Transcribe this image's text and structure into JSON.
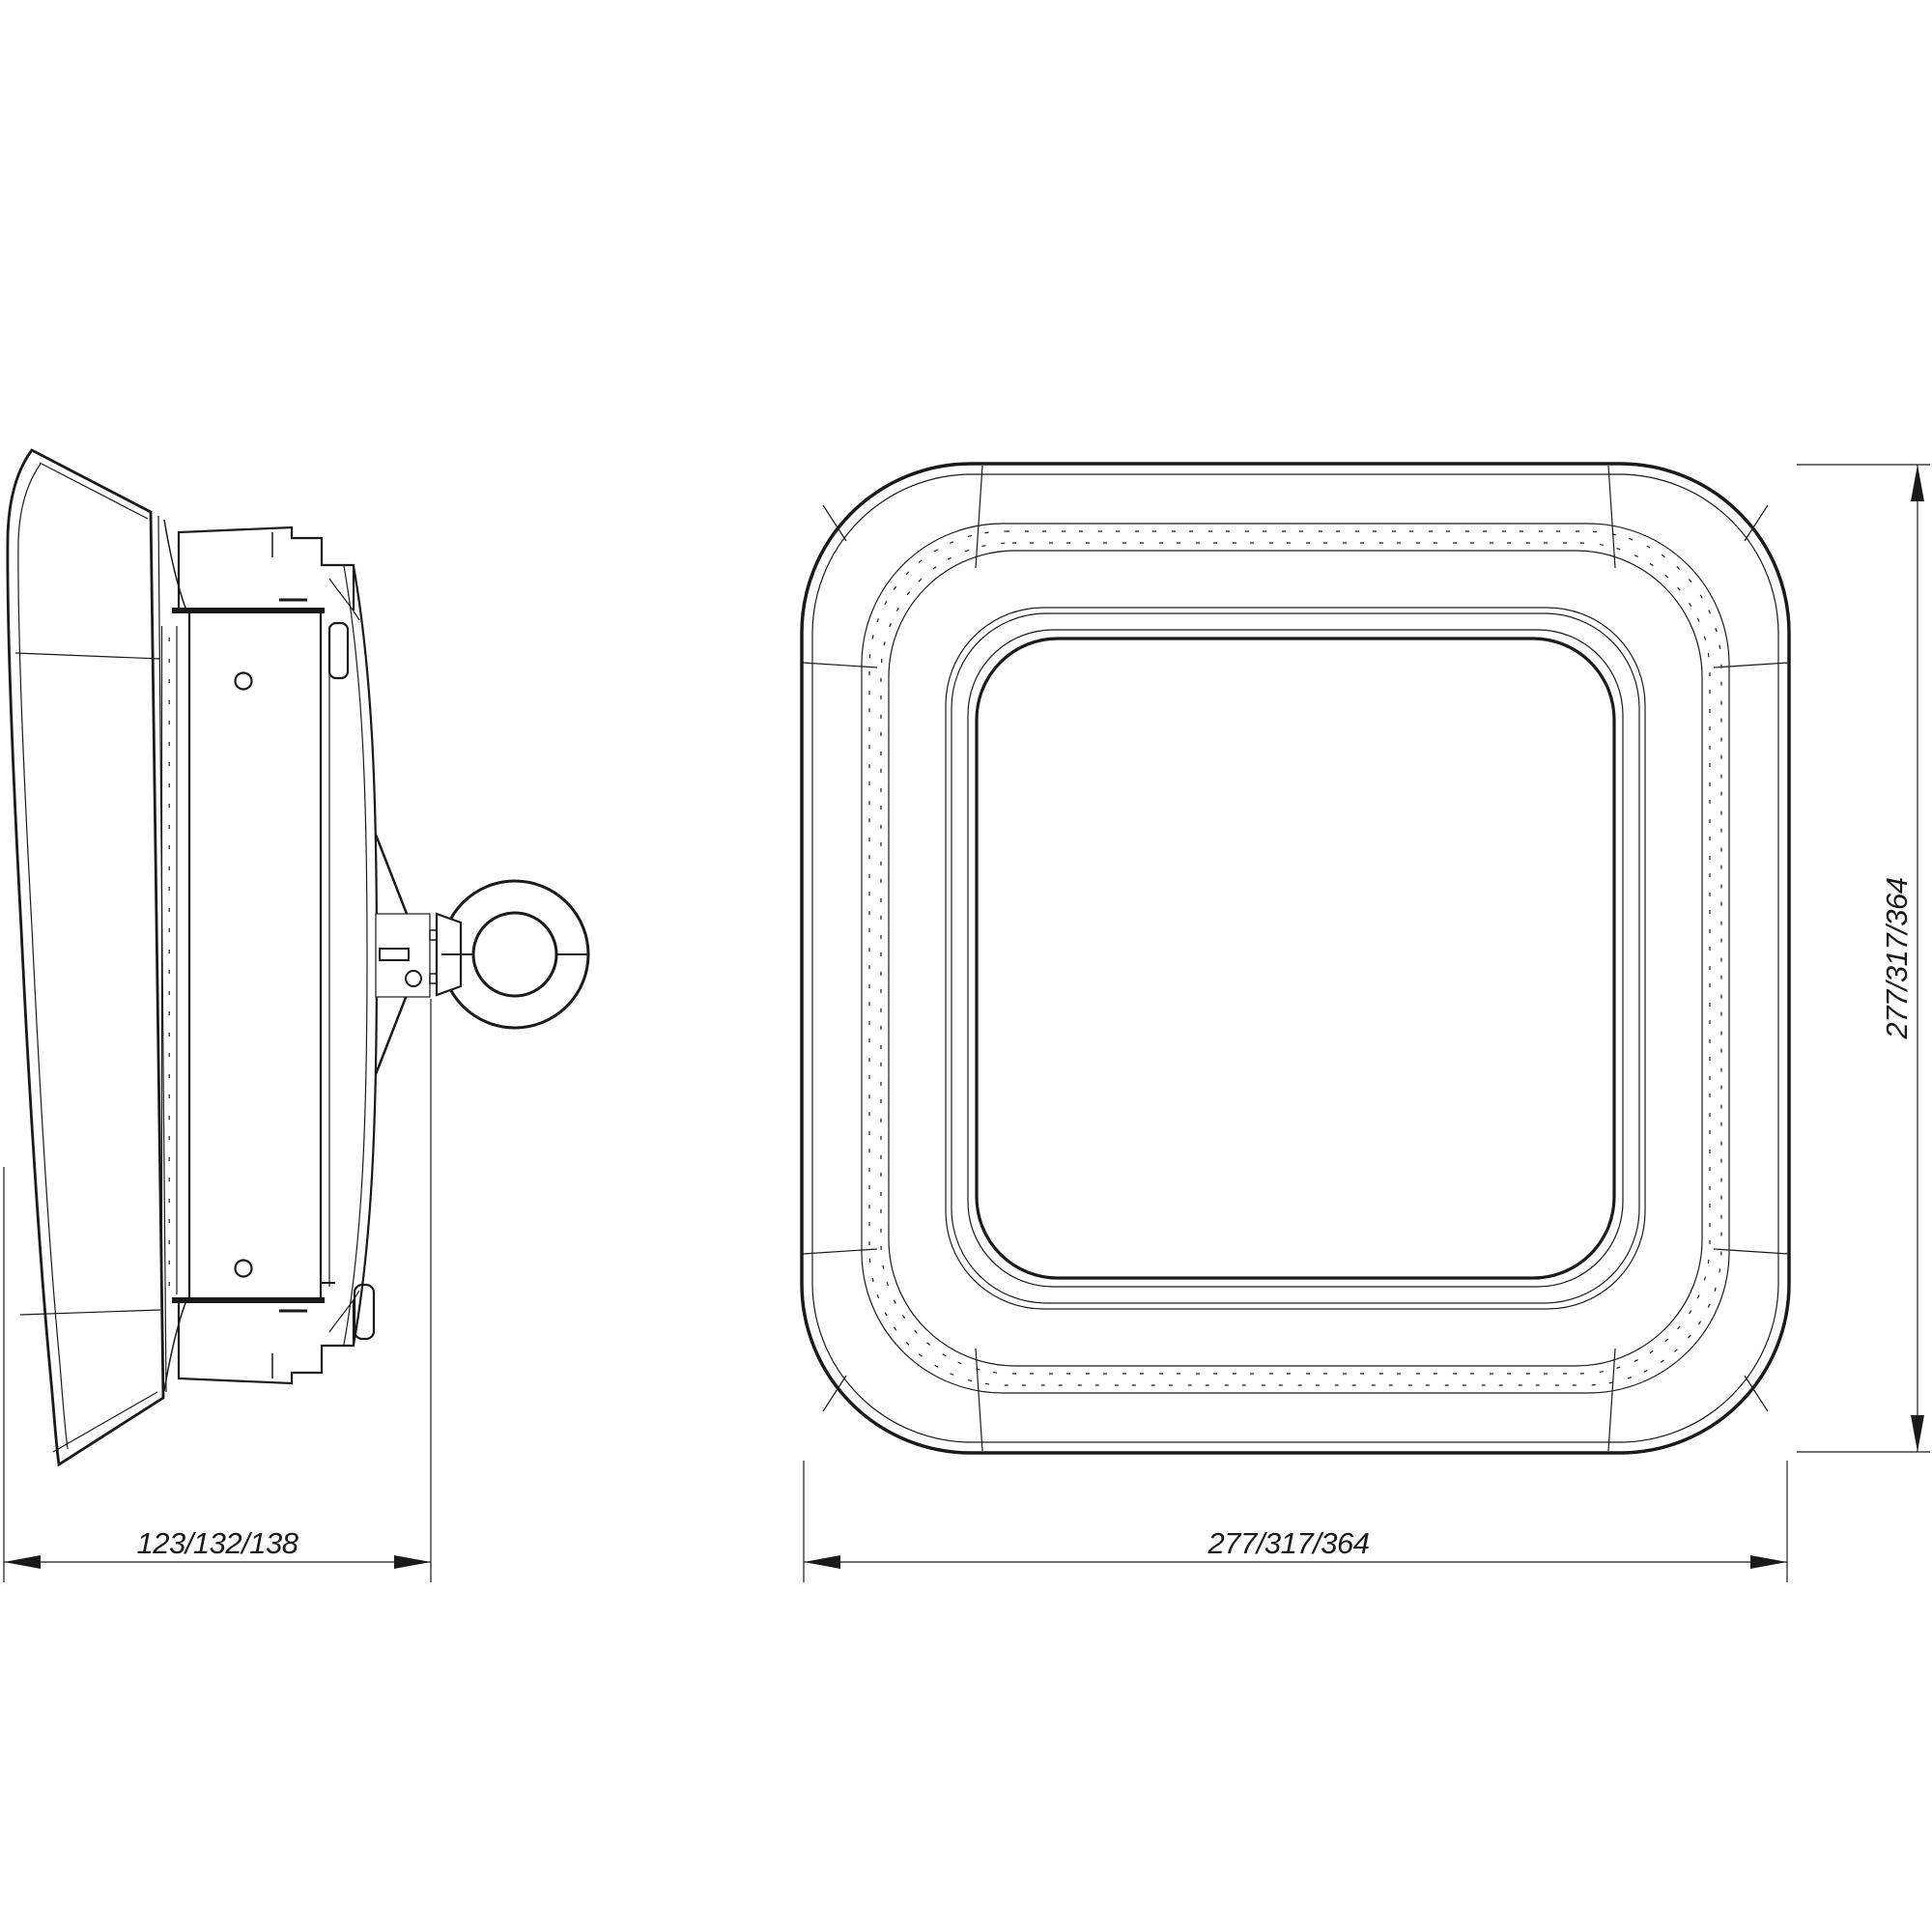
{
  "drawing": {
    "background_color": "#ffffff",
    "line_color": "#1a1a1a",
    "dimensions": {
      "side_width_label": "123/132/138",
      "front_width_label": "277/317/364",
      "front_height_label": "277/317/364"
    }
  }
}
